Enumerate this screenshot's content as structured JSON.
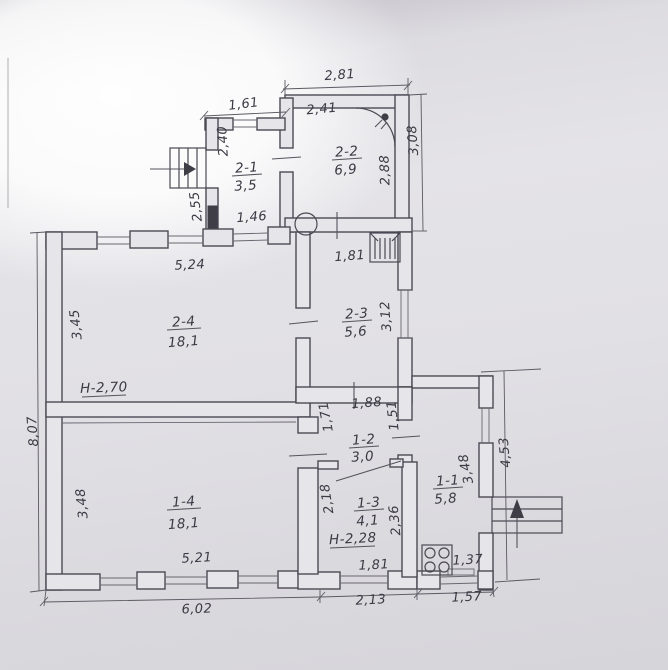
{
  "document": {
    "kind": "floor-plan photo",
    "ink_color": "#4b4953",
    "paper_color": "#e4e3e7"
  },
  "plan": {
    "rooms": [
      {
        "id": "2-1",
        "area": "3,5"
      },
      {
        "id": "2-2",
        "area": "6,9"
      },
      {
        "id": "2-3",
        "area": "5,6"
      },
      {
        "id": "2-4",
        "area": "18,1"
      },
      {
        "id": "1-1",
        "area": "5,8"
      },
      {
        "id": "1-2",
        "area": "3,0"
      },
      {
        "id": "1-3",
        "area": "4,1"
      },
      {
        "id": "1-4",
        "area": "18,1"
      }
    ],
    "height_labels": {
      "upper": "H-2,70",
      "lower": "H-2,28"
    },
    "dimensions": {
      "d281": "2,81",
      "d241": "2,41",
      "d161": "1,61",
      "d240": "2,40",
      "d308": "3,08",
      "d288": "2,88",
      "d255": "2,55",
      "d146": "1,46",
      "d181_room23": "1,81",
      "d312": "3,12",
      "d524": "5,24",
      "d345": "3,45",
      "d807": "8,07",
      "d188": "1,88",
      "d171": "1,71",
      "d151": "1,51",
      "d218": "2,18",
      "d236": "2,36",
      "d348_room14": "3,48",
      "d521": "5,21",
      "d181_room13": "1,81",
      "d602": "6,02",
      "d213": "2,13",
      "d157": "1,57",
      "d137": "1,37",
      "d348_room11": "3,48",
      "d453": "4,53"
    }
  }
}
